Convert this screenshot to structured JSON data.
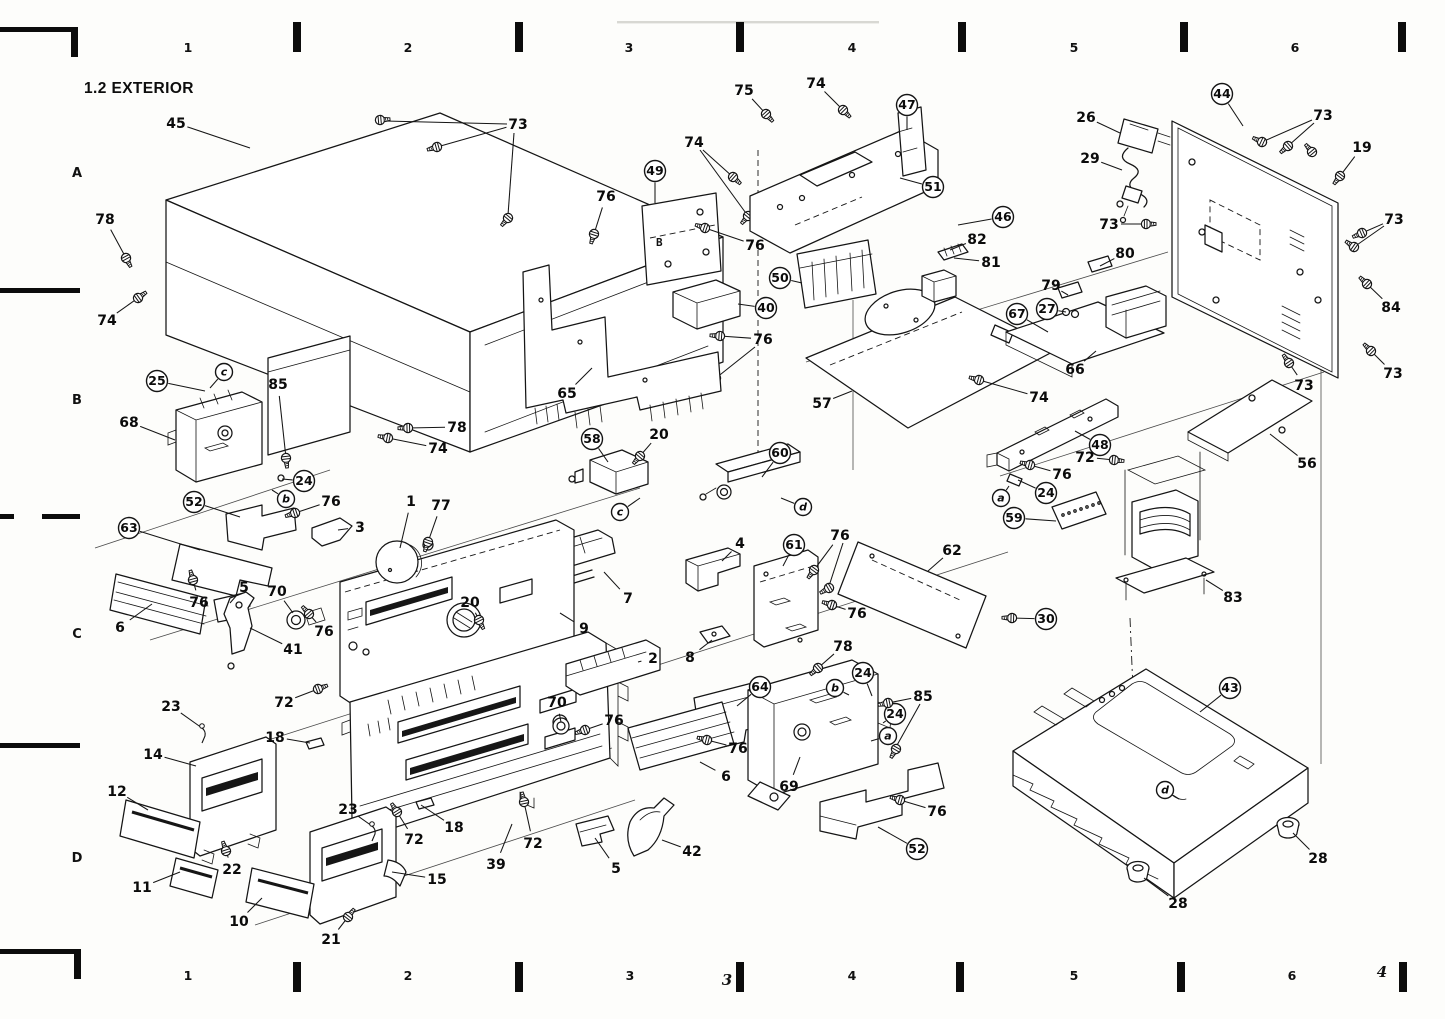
{
  "title": "1.2 EXTERIOR",
  "plate49_marking": "B",
  "grid": {
    "row_label_x": 77,
    "row_labels": [
      {
        "label": "A",
        "y": 177
      },
      {
        "label": "B",
        "y": 404
      },
      {
        "label": "C",
        "y": 638
      },
      {
        "label": "D",
        "y": 862
      }
    ],
    "top_label_y": 52,
    "top_labels": [
      {
        "label": "1",
        "x": 188
      },
      {
        "label": "2",
        "x": 408
      },
      {
        "label": "3",
        "x": 629
      },
      {
        "label": "4",
        "x": 852
      },
      {
        "label": "5",
        "x": 1074
      },
      {
        "label": "6",
        "x": 1295
      }
    ],
    "top_ticks_x": [
      297,
      519,
      740,
      962,
      1184,
      1402
    ],
    "bottom_label_y": 980,
    "bottom_labels": [
      {
        "label": "1",
        "x": 188
      },
      {
        "label": "2",
        "x": 408
      },
      {
        "label": "3",
        "x": 630
      },
      {
        "label": "4",
        "x": 852
      },
      {
        "label": "5",
        "x": 1074
      },
      {
        "label": "6",
        "x": 1292
      }
    ],
    "bottom_ticks_x": [
      297,
      519,
      740,
      960,
      1181,
      1403
    ],
    "bottom_handwritten": [
      {
        "label": "3",
        "x": 727,
        "y": 985
      },
      {
        "label": "4",
        "x": 1382,
        "y": 977
      }
    ]
  },
  "screw_labels": [
    "19",
    "20",
    "21",
    "22",
    "30",
    "72",
    "73",
    "74",
    "75",
    "76",
    "77",
    "78",
    "84",
    "85"
  ],
  "pin_labels": [
    "23"
  ],
  "callouts": [
    {
      "label": "45",
      "x": 176,
      "y": 123,
      "tx": 250,
      "ty": 148
    },
    {
      "label": "73",
      "x": 518,
      "y": 124,
      "tx": 437,
      "ty": 147
    },
    {
      "label": "78",
      "x": 105,
      "y": 219,
      "tx": 126,
      "ty": 258
    },
    {
      "label": "74",
      "x": 107,
      "y": 320,
      "tx": 138,
      "ty": 298
    },
    {
      "label": "25",
      "x": 157,
      "y": 381,
      "circled": true,
      "tx": 205,
      "ty": 391
    },
    {
      "label": "c",
      "x": 224,
      "y": 372,
      "circled": true,
      "letter": true,
      "tx": 210,
      "ty": 388
    },
    {
      "label": "85",
      "x": 278,
      "y": 384,
      "tx": 286,
      "ty": 458
    },
    {
      "label": "68",
      "x": 129,
      "y": 422,
      "tx": 175,
      "ty": 440
    },
    {
      "label": "78",
      "x": 457,
      "y": 427,
      "tx": 408,
      "ty": 428
    },
    {
      "label": "74",
      "x": 438,
      "y": 448,
      "tx": 388,
      "ty": 438
    },
    {
      "label": "24",
      "x": 304,
      "y": 481,
      "circled": true,
      "tx": 282,
      "ty": 479
    },
    {
      "label": "b",
      "x": 286,
      "y": 499,
      "circled": true,
      "letter": true,
      "tx": 272,
      "ty": 490
    },
    {
      "label": "76",
      "x": 331,
      "y": 501,
      "tx": 295,
      "ty": 513
    },
    {
      "label": "52",
      "x": 194,
      "y": 502,
      "circled": true,
      "tx": 240,
      "ty": 517
    },
    {
      "label": "3",
      "x": 360,
      "y": 527,
      "tx": 338,
      "ty": 530
    },
    {
      "label": "1",
      "x": 411,
      "y": 501,
      "tx": 400,
      "ty": 548
    },
    {
      "label": "77",
      "x": 441,
      "y": 505,
      "tx": 428,
      "ty": 542
    },
    {
      "label": "63",
      "x": 129,
      "y": 528,
      "circled": true,
      "tx": 200,
      "ty": 550
    },
    {
      "label": "76",
      "x": 199,
      "y": 602,
      "tx": 193,
      "ty": 580
    },
    {
      "label": "5",
      "x": 244,
      "y": 587,
      "tx": 230,
      "ty": 603
    },
    {
      "label": "70",
      "x": 277,
      "y": 591,
      "tx": 293,
      "ty": 613
    },
    {
      "label": "76",
      "x": 324,
      "y": 631,
      "tx": 309,
      "ty": 614
    },
    {
      "label": "41",
      "x": 293,
      "y": 649,
      "tx": 250,
      "ty": 628
    },
    {
      "label": "6",
      "x": 120,
      "y": 627,
      "tx": 152,
      "ty": 604
    },
    {
      "label": "20",
      "x": 470,
      "y": 602,
      "tx": 479,
      "ty": 620
    },
    {
      "label": "23",
      "x": 171,
      "y": 706,
      "tx": 202,
      "ty": 728
    },
    {
      "label": "72",
      "x": 284,
      "y": 702,
      "tx": 318,
      "ty": 689
    },
    {
      "label": "18",
      "x": 275,
      "y": 737,
      "tx": 310,
      "ty": 743
    },
    {
      "label": "14",
      "x": 153,
      "y": 754,
      "tx": 196,
      "ty": 766
    },
    {
      "label": "12",
      "x": 117,
      "y": 791,
      "tx": 148,
      "ty": 810
    },
    {
      "label": "22",
      "x": 232,
      "y": 869,
      "tx": 226,
      "ty": 851
    },
    {
      "label": "11",
      "x": 142,
      "y": 887,
      "tx": 180,
      "ty": 872
    },
    {
      "label": "10",
      "x": 239,
      "y": 921,
      "tx": 262,
      "ty": 898
    },
    {
      "label": "21",
      "x": 331,
      "y": 939,
      "tx": 348,
      "ty": 917
    },
    {
      "label": "15",
      "x": 437,
      "y": 879,
      "tx": 392,
      "ty": 872
    },
    {
      "label": "23",
      "x": 348,
      "y": 809,
      "tx": 372,
      "ty": 826
    },
    {
      "label": "72",
      "x": 414,
      "y": 839,
      "tx": 397,
      "ty": 812
    },
    {
      "label": "18",
      "x": 454,
      "y": 827,
      "tx": 421,
      "ty": 805
    },
    {
      "label": "39",
      "x": 496,
      "y": 864,
      "tx": 512,
      "ty": 824
    },
    {
      "label": "72",
      "x": 533,
      "y": 843,
      "tx": 524,
      "ty": 802
    },
    {
      "label": "5",
      "x": 616,
      "y": 868,
      "tx": 595,
      "ty": 838
    },
    {
      "label": "42",
      "x": 692,
      "y": 851,
      "tx": 662,
      "ty": 840
    },
    {
      "label": "2",
      "x": 653,
      "y": 658,
      "tx": 638,
      "ty": 662
    },
    {
      "label": "8",
      "x": 690,
      "y": 657,
      "tx": 712,
      "ty": 640
    },
    {
      "label": "7",
      "x": 628,
      "y": 598,
      "tx": 604,
      "ty": 572
    },
    {
      "label": "9",
      "x": 584,
      "y": 628,
      "tx": 560,
      "ty": 613
    },
    {
      "label": "65",
      "x": 567,
      "y": 393,
      "tx": 592,
      "ty": 368
    },
    {
      "label": "76",
      "x": 606,
      "y": 196,
      "tx": 594,
      "ty": 234
    },
    {
      "label": "49",
      "x": 655,
      "y": 171,
      "circled": true,
      "tx": 655,
      "ty": 203
    },
    {
      "label": "76",
      "x": 755,
      "y": 245,
      "tx": 705,
      "ty": 228
    },
    {
      "label": "74",
      "x": 694,
      "y": 142,
      "tx": 733,
      "ty": 177
    },
    {
      "label": "75",
      "x": 744,
      "y": 90,
      "tx": 766,
      "ty": 114
    },
    {
      "label": "74",
      "x": 816,
      "y": 83,
      "tx": 843,
      "ty": 110
    },
    {
      "label": "47",
      "x": 907,
      "y": 105,
      "circled": true,
      "tx": 907,
      "ty": 130
    },
    {
      "label": "51",
      "x": 933,
      "y": 187,
      "circled": true,
      "tx": 900,
      "ty": 178
    },
    {
      "label": "46",
      "x": 1003,
      "y": 217,
      "circled": true,
      "tx": 958,
      "ty": 225
    },
    {
      "label": "82",
      "x": 977,
      "y": 239,
      "tx": 950,
      "ty": 250
    },
    {
      "label": "81",
      "x": 991,
      "y": 262,
      "tx": 954,
      "ty": 258
    },
    {
      "label": "50",
      "x": 780,
      "y": 278,
      "circled": true,
      "tx": 802,
      "ty": 283
    },
    {
      "label": "40",
      "x": 766,
      "y": 308,
      "circled": true,
      "tx": 738,
      "ty": 304
    },
    {
      "label": "76",
      "x": 763,
      "y": 339,
      "tx": 720,
      "ty": 336
    },
    {
      "label": "67",
      "x": 1017,
      "y": 314,
      "circled": true,
      "tx": 1048,
      "ty": 332
    },
    {
      "label": "27",
      "x": 1047,
      "y": 309,
      "circled": true,
      "tx": 1066,
      "ty": 312
    },
    {
      "label": "79",
      "x": 1051,
      "y": 285,
      "tx": 1068,
      "ty": 295
    },
    {
      "label": "80",
      "x": 1125,
      "y": 253,
      "tx": 1100,
      "ty": 266
    },
    {
      "label": "26",
      "x": 1086,
      "y": 117,
      "tx": 1120,
      "ty": 133
    },
    {
      "label": "29",
      "x": 1090,
      "y": 158,
      "tx": 1122,
      "ty": 170
    },
    {
      "label": "44",
      "x": 1222,
      "y": 94,
      "circled": true,
      "tx": 1243,
      "ty": 126
    },
    {
      "label": "73",
      "x": 1323,
      "y": 115,
      "tx": 1288,
      "ty": 146
    },
    {
      "label": "19",
      "x": 1362,
      "y": 147,
      "tx": 1340,
      "ty": 176
    },
    {
      "label": "73",
      "x": 1109,
      "y": 224,
      "tx": 1146,
      "ty": 224
    },
    {
      "label": "73",
      "x": 1394,
      "y": 219,
      "tx": 1362,
      "ty": 233
    },
    {
      "label": "84",
      "x": 1391,
      "y": 307,
      "tx": 1367,
      "ty": 284
    },
    {
      "label": "73",
      "x": 1304,
      "y": 385,
      "tx": 1289,
      "ty": 363
    },
    {
      "label": "73",
      "x": 1393,
      "y": 373,
      "tx": 1371,
      "ty": 351
    },
    {
      "label": "57",
      "x": 822,
      "y": 403,
      "tx": 852,
      "ty": 391
    },
    {
      "label": "74",
      "x": 1039,
      "y": 397,
      "tx": 979,
      "ty": 380
    },
    {
      "label": "66",
      "x": 1075,
      "y": 369,
      "tx": 1096,
      "ty": 351
    },
    {
      "label": "48",
      "x": 1100,
      "y": 445,
      "circled": true,
      "tx": 1075,
      "ty": 431
    },
    {
      "label": "72",
      "x": 1085,
      "y": 457,
      "tx": 1114,
      "ty": 460
    },
    {
      "label": "76",
      "x": 1062,
      "y": 474,
      "tx": 1030,
      "ty": 465
    },
    {
      "label": "24",
      "x": 1046,
      "y": 493,
      "circled": true,
      "tx": 1018,
      "ty": 480
    },
    {
      "label": "a",
      "x": 1001,
      "y": 498,
      "circled": true,
      "letter": true,
      "tx": 1009,
      "ty": 486
    },
    {
      "label": "59",
      "x": 1014,
      "y": 518,
      "circled": true,
      "tx": 1056,
      "ty": 521
    },
    {
      "label": "56",
      "x": 1307,
      "y": 463,
      "tx": 1270,
      "ty": 434
    },
    {
      "label": "83",
      "x": 1233,
      "y": 597,
      "tx": 1206,
      "ty": 580
    },
    {
      "label": "30",
      "x": 1046,
      "y": 619,
      "circled": true,
      "tx": 1012,
      "ty": 618
    },
    {
      "label": "43",
      "x": 1230,
      "y": 688,
      "circled": true,
      "tx": 1200,
      "ty": 712
    },
    {
      "label": "28",
      "x": 1318,
      "y": 858,
      "tx": 1293,
      "ty": 833
    },
    {
      "label": "28",
      "x": 1178,
      "y": 903,
      "tx": 1144,
      "ty": 878
    },
    {
      "label": "d",
      "x": 1165,
      "y": 790,
      "circled": true,
      "letter": true,
      "tx": 1179,
      "ty": 799
    },
    {
      "label": "58",
      "x": 592,
      "y": 439,
      "circled": true,
      "tx": 608,
      "ty": 462
    },
    {
      "label": "20",
      "x": 659,
      "y": 434,
      "tx": 640,
      "ty": 456
    },
    {
      "label": "c",
      "x": 620,
      "y": 512,
      "circled": true,
      "letter": true,
      "tx": 640,
      "ty": 498
    },
    {
      "label": "60",
      "x": 780,
      "y": 453,
      "circled": true,
      "tx": 762,
      "ty": 477
    },
    {
      "label": "d",
      "x": 803,
      "y": 507,
      "circled": true,
      "letter": true,
      "tx": 781,
      "ty": 498
    },
    {
      "label": "4",
      "x": 740,
      "y": 543,
      "tx": 722,
      "ty": 561
    },
    {
      "label": "61",
      "x": 794,
      "y": 545,
      "circled": true,
      "tx": 783,
      "ty": 566
    },
    {
      "label": "76",
      "x": 840,
      "y": 535,
      "tx": 814,
      "ty": 570
    },
    {
      "label": "62",
      "x": 952,
      "y": 550,
      "tx": 928,
      "ty": 571
    },
    {
      "label": "76",
      "x": 857,
      "y": 613,
      "tx": 832,
      "ty": 605
    },
    {
      "label": "78",
      "x": 843,
      "y": 646,
      "tx": 818,
      "ty": 668
    },
    {
      "label": "64",
      "x": 760,
      "y": 687,
      "circled": true,
      "tx": 737,
      "ty": 706
    },
    {
      "label": "70",
      "x": 557,
      "y": 702,
      "tx": 561,
      "ty": 722
    },
    {
      "label": "76",
      "x": 614,
      "y": 720,
      "tx": 585,
      "ty": 730
    },
    {
      "label": "76",
      "x": 738,
      "y": 748,
      "tx": 707,
      "ty": 740
    },
    {
      "label": "6",
      "x": 726,
      "y": 776,
      "tx": 700,
      "ty": 762
    },
    {
      "label": "69",
      "x": 789,
      "y": 786,
      "tx": 800,
      "ty": 757
    },
    {
      "label": "b",
      "x": 835,
      "y": 688,
      "circled": true,
      "letter": true,
      "tx": 849,
      "ty": 695
    },
    {
      "label": "24",
      "x": 863,
      "y": 673,
      "circled": true,
      "tx": 872,
      "ty": 696
    },
    {
      "label": "24",
      "x": 895,
      "y": 714,
      "circled": true,
      "tx": 883,
      "ty": 723
    },
    {
      "label": "a",
      "x": 888,
      "y": 736,
      "circled": true,
      "letter": true,
      "tx": 871,
      "ty": 741
    },
    {
      "label": "85",
      "x": 923,
      "y": 696,
      "tx": 888,
      "ty": 703
    },
    {
      "label": "76",
      "x": 937,
      "y": 811,
      "tx": 900,
      "ty": 800
    },
    {
      "label": "52",
      "x": 917,
      "y": 849,
      "circled": true,
      "tx": 878,
      "ty": 827
    }
  ]
}
